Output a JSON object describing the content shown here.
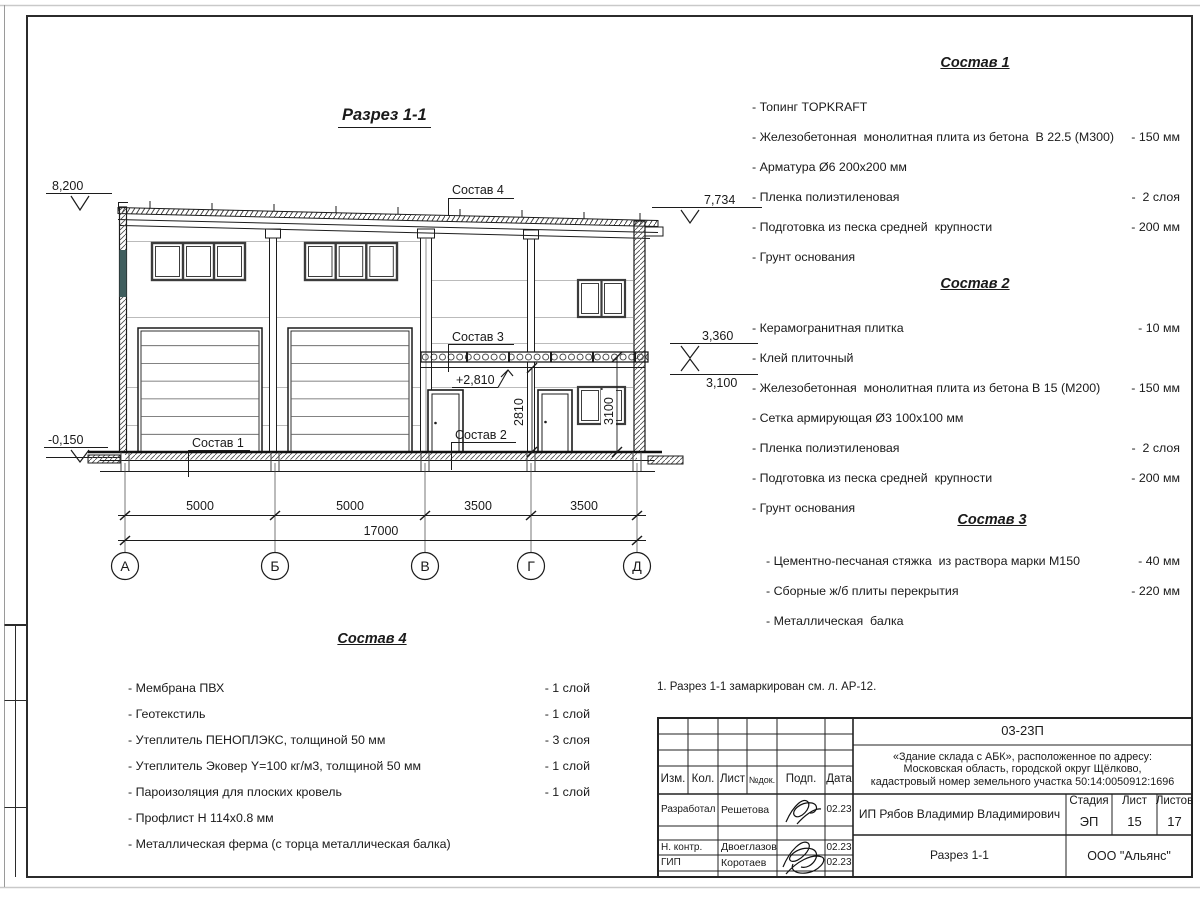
{
  "page": {
    "drawing_title": "Разрез 1-1",
    "note": "1. Разрез 1-1 замаркирован см. л. АР-12."
  },
  "section": {
    "axes": [
      "А",
      "Б",
      "В",
      "Г",
      "Д"
    ],
    "dims_row1": [
      "5000",
      "5000",
      "3500",
      "3500"
    ],
    "dim_total": "17000",
    "elev_8200": "8,200",
    "elev_7734": "7,734",
    "elev_3360": "3,360",
    "elev_3100": "3,100",
    "elev_m0150": "-0,150",
    "elev_2810": "+2,810",
    "dim_2810": "2810",
    "dim_3100": "3100",
    "lbl_sostav1": "Состав  1",
    "lbl_sostav2": "Состав  2",
    "lbl_sostav3": "Состав  3",
    "lbl_sostav4": "Состав 4"
  },
  "comp1": {
    "title": "Состав 1",
    "items": [
      {
        "name": "- Топинг TOPKRAFT",
        "value": ""
      },
      {
        "name": "- Железобетонная  монолитная плита из бетона  В 22.5 (М300)",
        "value": "- 150 мм"
      },
      {
        "name": "- Арматура Ø6 200х200 мм",
        "value": ""
      },
      {
        "name": "- Пленка полиэтиленовая",
        "value": "-  2 слоя"
      },
      {
        "name": "- Подготовка из песка средней  крупности",
        "value": "- 200 мм"
      },
      {
        "name": "- Грунт основания",
        "value": ""
      }
    ]
  },
  "comp2": {
    "title": "Состав 2",
    "items": [
      {
        "name": "- Керамогранитная плитка",
        "value": "- 10 мм"
      },
      {
        "name": "- Клей плиточный",
        "value": ""
      },
      {
        "name": "- Железобетонная  монолитная плита из бетона В 15 (М200)",
        "value": "- 150 мм"
      },
      {
        "name": "- Сетка армирующая Ø3 100х100 мм",
        "value": ""
      },
      {
        "name": "- Пленка полиэтиленовая",
        "value": "-  2 слоя"
      },
      {
        "name": "- Подготовка из песка средней  крупности",
        "value": "- 200 мм"
      },
      {
        "name": "- Грунт основания",
        "value": ""
      }
    ]
  },
  "comp3": {
    "title": "Состав 3",
    "items": [
      {
        "name": "- Цементно-песчаная стяжка  из раствора марки М150",
        "value": "- 40 мм"
      },
      {
        "name": "- Сборные ж/б плиты перекрытия",
        "value": "- 220 мм"
      },
      {
        "name": "- Металлическая  балка",
        "value": ""
      }
    ]
  },
  "comp4": {
    "title": "Состав 4",
    "items": [
      {
        "name": "- Мембрана ПВХ",
        "value": "- 1 слой"
      },
      {
        "name": "- Геотекстиль",
        "value": "- 1 слой"
      },
      {
        "name": "- Утеплитель ПЕНОПЛЭКС, толщиной 50 мм",
        "value": "- 3 слоя"
      },
      {
        "name": "- Утеплитель Эковер Y=100 кг/м3, толщиной 50 мм",
        "value": "- 1 слой"
      },
      {
        "name": "- Пароизоляция для плоских кровель",
        "value": "- 1 слой"
      },
      {
        "name": "- Профлист Н 114х0.8 мм",
        "value": ""
      },
      {
        "name": "- Металлическая ферма (с торца металлическая балка)",
        "value": ""
      }
    ]
  },
  "titleblock": {
    "code": "03-23П",
    "object_line1": "«Здание склада с АБК», расположенное по адресу:",
    "object_line2": "Московская область, городской округ Щёлково,",
    "object_line3": "кадастровый номер земельного участка 50:14:0050912:1696",
    "col_izm": "Изм.",
    "col_kol": "Кол.",
    "col_list": "Лист",
    "col_ndok": "№док.",
    "col_podp": "Подп.",
    "col_data": "Дата",
    "row1_role": "Разработал",
    "row1_name": "Решетова",
    "row1_date": "02.23",
    "row2_role": "Н. контр.",
    "row2_name": "Двоеглазов",
    "row2_date": "02.23",
    "row3_role": "ГИП",
    "row3_name": "Коротаев",
    "row3_date": "02.23",
    "client": "ИП Рябов Владимир Владимирович",
    "stage_label": "Стадия",
    "sheet_label": "Лист",
    "sheets_label": "Листов",
    "stage": "ЭП",
    "sheet": "15",
    "sheets": "17",
    "doc_name": "Разрез 1-1",
    "company": "ООО \"Альянс\""
  }
}
